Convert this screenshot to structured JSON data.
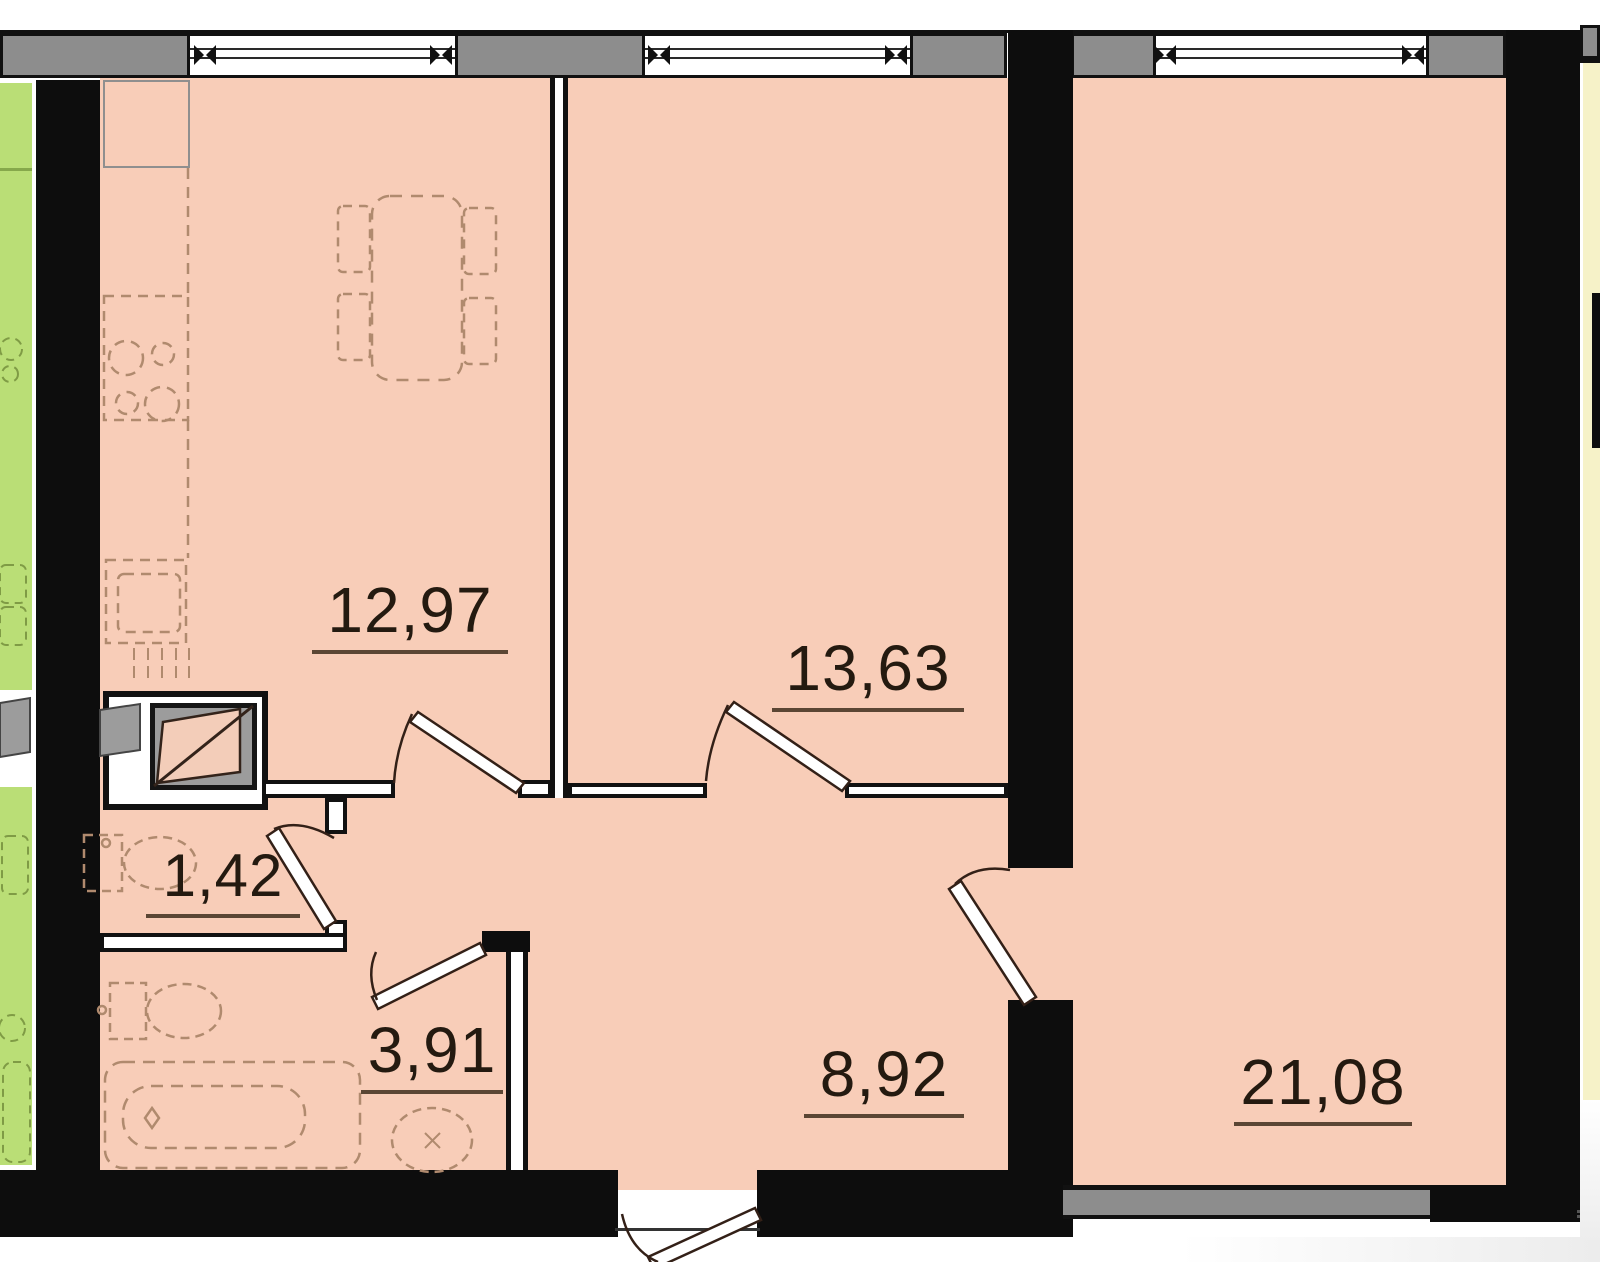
{
  "rooms": [
    {
      "id": "kitchen",
      "area_label": "12,97"
    },
    {
      "id": "bedroom",
      "area_label": "13,63"
    },
    {
      "id": "water-closet",
      "area_label": "1,42"
    },
    {
      "id": "bathroom",
      "area_label": "3,91"
    },
    {
      "id": "hallway",
      "area_label": "8,92"
    },
    {
      "id": "living-room",
      "area_label": "21,08"
    }
  ],
  "colors": {
    "room_fill": "#f8cdb8",
    "balcony_fill": "#bade76",
    "neighbor_fill": "#f6f2c8",
    "wall": "#0d0d0d",
    "sill": "#8d8d8d",
    "label_text": "#241a10",
    "label_underline": "#5b4634",
    "furniture_stroke": "#b08a6e",
    "balcony_stroke": "#7f9b45",
    "door_stroke": "#332017",
    "vent_gray": "#9c9c9c",
    "bg": "#ffffff"
  },
  "icons": [
    "window-icon",
    "window-mullion-icon",
    "door-swing-icon",
    "entrance-door-icon",
    "ventilation-shaft-icon",
    "dining-table-icon",
    "chair-icon",
    "stove-icon",
    "kitchen-sink-icon",
    "toilet-icon",
    "bathtub-icon",
    "washbasin-icon",
    "balcony-plant-icon"
  ]
}
